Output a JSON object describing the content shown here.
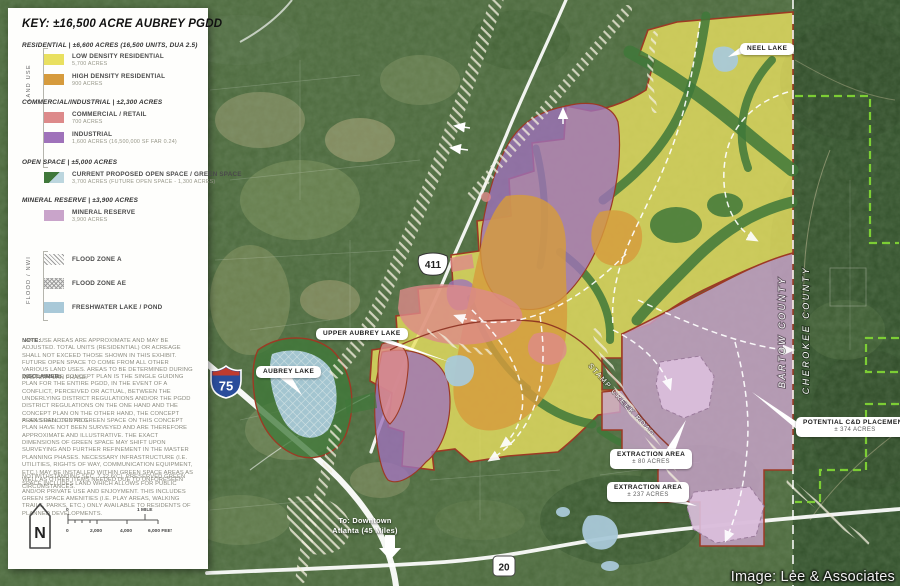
{
  "colors": {
    "low_density": "#E9E060",
    "high_density": "#D69B3D",
    "commercial": "#DD8A8A",
    "industrial": "#9F72BA",
    "open_space_green": "#40783A",
    "open_space_blue": "#BCD6DE",
    "mineral_reserve": "#C9A4CA",
    "freshwater": "#A9C9D8",
    "boundary_red": "#9C3A24",
    "cd_boundary_green": "#7FD435"
  },
  "legend": {
    "title": "KEY: ±16,500 ACRE AUBREY PGDD",
    "land_use_label": "LAND USE",
    "flood_label": "FLOOD / NWI",
    "residential": {
      "heading": "RESIDENTIAL  |  ±6,600 ACRES (16,500 UNITS, DUA 2.5)",
      "low": {
        "label": "LOW DENSITY RESIDENTIAL",
        "acres": "5,700 ACRES",
        "color": "#E9E060"
      },
      "high": {
        "label": "HIGH DENSITY RESIDENTIAL",
        "acres": "900 ACRES",
        "color": "#D69B3D"
      }
    },
    "commercial_industrial": {
      "heading": "COMMERCIAL/INDUSTRIAL  |  ±2,300 ACRES",
      "commercial": {
        "label": "COMMERCIAL / RETAIL",
        "acres": "700 ACRES",
        "color": "#DD8A8A"
      },
      "industrial": {
        "label": "INDUSTRIAL",
        "acres": "1,600 ACRES (16,500,000 SF FAR 0.24)",
        "color": "#9F72BA"
      }
    },
    "open_space": {
      "heading": "OPEN SPACE  |  ±5,000 ACRES",
      "item": {
        "label": "CURRENT PROPOSED OPEN SPACE / GREEN SPACE",
        "acres": "3,700 ACRES (FUTURE OPEN SPACE - 1,300 ACRES)",
        "color_green": "#40783A",
        "color_blue": "#BCD6DE"
      }
    },
    "mineral": {
      "heading": "MINERAL RESERVE  |  ±3,900 ACRES",
      "item": {
        "label": "MINERAL RESERVE",
        "acres": "3,900 ACRES",
        "color": "#C9A4CA"
      }
    },
    "flood": {
      "zone_a": {
        "label": "FLOOD ZONE A"
      },
      "zone_ae": {
        "label": "FLOOD ZONE AE"
      },
      "freshwater": {
        "label": "FRESHWATER LAKE / POND",
        "color": "#A9C9D8"
      }
    },
    "note_label": "NOTE:",
    "note": "LAND USE AREAS ARE APPROXIMATE AND MAY BE ADJUSTED. TOTAL UNITS (RESIDENTIAL) OR ACREAGE SHALL NOT EXCEED THOSE SHOWN IN THIS EXHIBIT. FUTURE OPEN SPACE TO COME FROM ALL OTHER VARIOUS LAND USES. AREAS TO BE DETERMINED DURING MASTER PLAN PHASE.",
    "disclaimer_label": "DISCLAIMER:",
    "disclaimer": "BECAUSE THE CONCEPT PLAN IS THE SINGLE GUIDING PLAN FOR THE ENTIRE PGDD, IN THE EVENT OF A CONFLICT, PERCEIVED OR ACTUAL, BETWEEN THE UNDERLYING DISTRICT REGULATIONS AND/OR THE PGDD DISTRICT REGULATIONS ON THE ONE HAND AND THE CONCEPT PLAN ON THE OTHER HAND, THE CONCEPT PLAN SHALL CONTROL.",
    "green_space_para": "AREAS DENOTED AS GREEN SPACE ON THIS CONCEPT PLAN HAVE NOT BEEN SURVEYED AND ARE THEREFORE APPROXIMATE AND ILLUSTRATIVE. THE EXACT DIMENSIONS OF GREEN SPACE MAY SHIFT UPON SURVEYING AND FURTHER REFINEMENT IN THE MASTER PLANNING PHASES. NECESSARY INFRASTRUCTURE (I.E. UTILITIES, RIGHTS OF WAY, COMMUNICATION EQUIPMENT, ETC.) MAY BE INSTALLED WITHIN GREEN SPACE AREAS AS WELL AS OTHER ITEMS NEEDED DUE TO UNFORESEEN CIRCUMSTANCES.",
    "preserved_para": "NOTWITHSTANDING SEC. 7.22.6(C), PRESERVED GREEN SPACE INCLUDES LAND WHICH ALLOWS FOR PUBLIC AND/OR PRIVATE USE AND ENJOYMENT. THIS INCLUDES GREEN SPACE AMENITIES (I.E. PLAY AREAS, WALKING TRAILS, PARKS, ETC.) ONLY AVAILABLE TO RESIDENTS OF PLANNED DEVELOPMENTS.",
    "north": "N",
    "scale": {
      "mile_zero": "0",
      "mile": "1 MILE",
      "feet": [
        "0",
        "2,000",
        "4,000",
        "6,000 FEET"
      ]
    }
  },
  "map": {
    "callouts": {
      "neel": "NEEL LAKE",
      "upper_aubrey": "UPPER AUBREY LAKE",
      "aubrey": "AUBREY LAKE",
      "ext80": {
        "title": "EXTRACTION AREA",
        "acres": "± 80 ACRES"
      },
      "ext237": {
        "title": "EXTRACTION AREA",
        "acres": "± 237 ACRES"
      },
      "cd": {
        "title": "POTENTIAL C&D PLACEMENT",
        "acres": "± 374 ACRES"
      }
    },
    "counties": {
      "west": "BARTOW COUNTY",
      "east": "CHEROKEE COUNTY"
    },
    "shields": {
      "interstate": "75",
      "us": "411",
      "state": "20"
    },
    "stamp_creek_road": "STAMP CREEK ROAD",
    "atlanta_line1": "To: Downtown",
    "atlanta_line2": "Atlanta (45 Miles)"
  },
  "page": {
    "credit": "Image: Lee & Associates"
  }
}
